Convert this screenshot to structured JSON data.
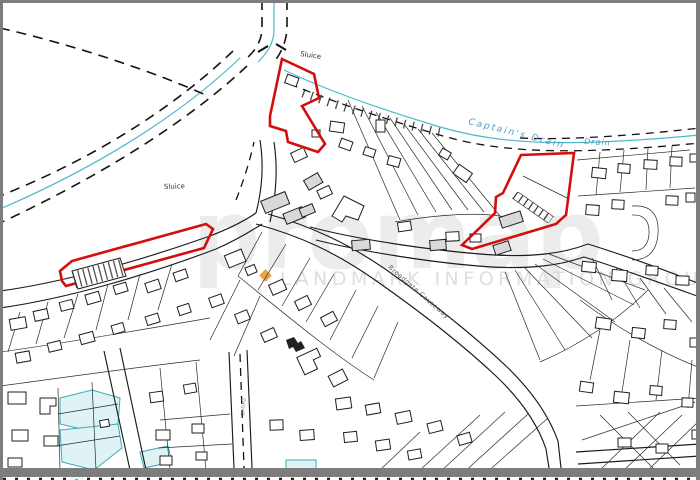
{
  "map": {
    "labels": {
      "sluice_top": "Sluice",
      "sluice_left": "Sluice",
      "captains_drain": "Captain's Drain",
      "drain": "Drain",
      "road_diagonal": "Broadgate Causeway",
      "road_vertical": "Drove"
    },
    "watermark": {
      "brand": "promap",
      "org": "LANDMARK INFORMATION GROUP"
    },
    "colors": {
      "parcel_red": "#d40d0d",
      "water_line": "#49b9c9",
      "water_fill": "#dff3f5",
      "water_text": "#4a9ec5",
      "watermark_gray": "#ececec",
      "org_gray": "#dedede",
      "logo_orange": "#eba24a",
      "frame_gray": "#7d7d7d"
    }
  }
}
